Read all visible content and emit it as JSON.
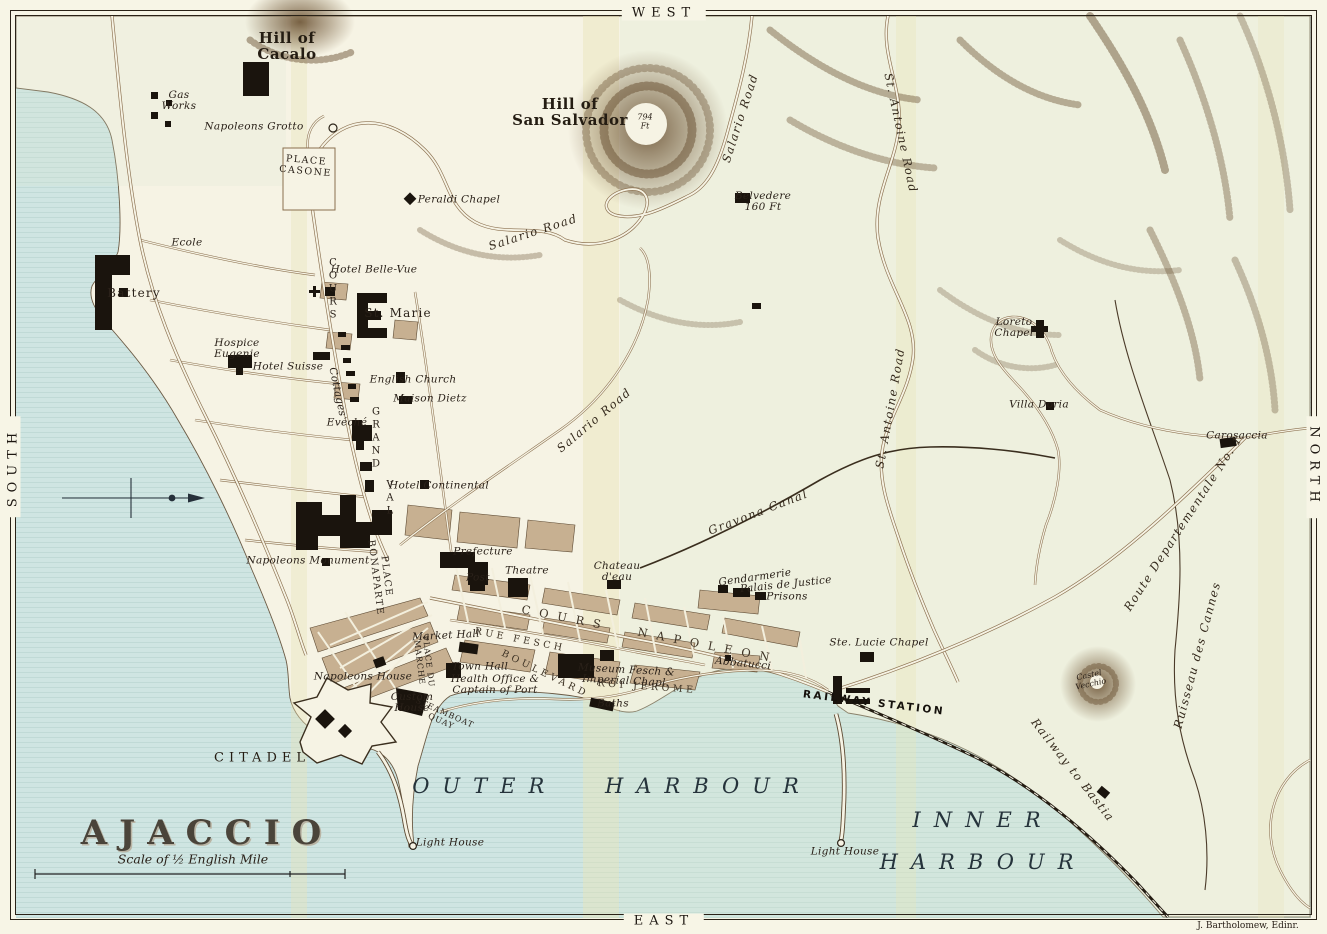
{
  "map": {
    "title": "AJACCIO",
    "scale_label": "Scale of ½ English Mile",
    "attribution": "J. Bartholomew, Edinr.",
    "compass": {
      "top": "WEST",
      "bottom": "EAST",
      "left": "SOUTH",
      "right": "NORTH"
    },
    "colors": {
      "sea": "#cfe5e2",
      "land": "#f6f3e4",
      "buildings": "#1a140d",
      "blocks": "#c7b091",
      "hills": "#6e5638",
      "fold_band": "#e8e4b8"
    }
  },
  "labels": [
    {
      "name": "hill-of-cacalo",
      "text": "Hill of\nCacalo",
      "x": 287,
      "y": 46,
      "rot": 0,
      "cls": "hill"
    },
    {
      "name": "gas-works",
      "text": "Gas\nWorks",
      "x": 179,
      "y": 101,
      "rot": 0,
      "cls": "place"
    },
    {
      "name": "napoleons-grotto",
      "text": "Napoleons Grotto",
      "x": 254,
      "y": 127,
      "rot": 0,
      "cls": "place"
    },
    {
      "name": "place-casone",
      "text": "PLACE\nCASONE",
      "x": 306,
      "y": 166,
      "rot": 5,
      "cls": "district"
    },
    {
      "name": "peraldi-chapel",
      "text": "Peraldi Chapel",
      "x": 459,
      "y": 200,
      "rot": 0,
      "cls": "place"
    },
    {
      "name": "hill-of-san-salvador",
      "text": "Hill of\nSan Salvador",
      "x": 570,
      "y": 112,
      "rot": 0,
      "cls": "hill"
    },
    {
      "name": "summit-height",
      "text": "794\nFt",
      "x": 645,
      "y": 122,
      "rot": 0,
      "cls": "tiny"
    },
    {
      "name": "belvedere",
      "text": "Belvedere\n160 Ft",
      "x": 763,
      "y": 202,
      "rot": 0,
      "cls": "place"
    },
    {
      "name": "salario-road-north",
      "text": "Salario Road",
      "x": 740,
      "y": 118,
      "rot": -72,
      "cls": "road"
    },
    {
      "name": "salario-road-mid",
      "text": "Salario Road",
      "x": 533,
      "y": 232,
      "rot": -18,
      "cls": "road"
    },
    {
      "name": "salario-road-south",
      "text": "Salario Road",
      "x": 594,
      "y": 420,
      "rot": -40,
      "cls": "road"
    },
    {
      "name": "ecole",
      "text": "Ecole",
      "x": 187,
      "y": 243,
      "rot": 0,
      "cls": "place"
    },
    {
      "name": "battery",
      "text": "Battery",
      "x": 134,
      "y": 293,
      "rot": 0,
      "cls": "town"
    },
    {
      "name": "hospice-eugenie",
      "text": "Hospice\nEugenie",
      "x": 237,
      "y": 349,
      "rot": 0,
      "cls": "place"
    },
    {
      "name": "hotel-suisse",
      "text": "Hotel Suisse",
      "x": 288,
      "y": 367,
      "rot": 0,
      "cls": "place"
    },
    {
      "name": "cottages",
      "text": "Cottages",
      "x": 337,
      "y": 392,
      "rot": 78,
      "cls": "place"
    },
    {
      "name": "hotel-belle-vue",
      "text": "Hotel Belle-Vue",
      "x": 374,
      "y": 270,
      "rot": 0,
      "cls": "place"
    },
    {
      "name": "st-marie",
      "text": "St. Marie",
      "x": 398,
      "y": 313,
      "rot": 0,
      "cls": "town"
    },
    {
      "name": "english-church",
      "text": "English Church",
      "x": 413,
      "y": 380,
      "rot": 0,
      "cls": "place"
    },
    {
      "name": "maison-dietz",
      "text": "Maison Dietz",
      "x": 430,
      "y": 399,
      "rot": 0,
      "cls": "place"
    },
    {
      "name": "eveche",
      "text": "Evéché",
      "x": 347,
      "y": 423,
      "rot": 0,
      "cls": "place"
    },
    {
      "name": "cours-grandval-c",
      "text": "C\nO\nU\nR\nS",
      "x": 333,
      "y": 289,
      "rot": 0,
      "cls": "stack"
    },
    {
      "name": "cours-grandval-g",
      "text": "G\nR\nA\nN\nD",
      "x": 376,
      "y": 438,
      "rot": 0,
      "cls": "stack"
    },
    {
      "name": "cours-grandval-v",
      "text": "V\nA\nL",
      "x": 390,
      "y": 498,
      "rot": 0,
      "cls": "stack"
    },
    {
      "name": "hotel-continental",
      "text": "Hotel Continental",
      "x": 439,
      "y": 486,
      "rot": 0,
      "cls": "place"
    },
    {
      "name": "napoleons-monument",
      "text": "Napoleons Monument",
      "x": 308,
      "y": 561,
      "rot": 0,
      "cls": "place"
    },
    {
      "name": "place-bonaparte",
      "text": "PLACE\nBONAPARTE",
      "x": 381,
      "y": 577,
      "rot": 83,
      "cls": "district"
    },
    {
      "name": "prefecture",
      "text": "Prefecture",
      "x": 483,
      "y": 552,
      "rot": 0,
      "cls": "place"
    },
    {
      "name": "post",
      "text": "Post",
      "x": 478,
      "y": 578,
      "rot": 0,
      "cls": "place"
    },
    {
      "name": "theatre",
      "text": "Theatre",
      "x": 527,
      "y": 571,
      "rot": 0,
      "cls": "place"
    },
    {
      "name": "chateau-deau",
      "text": "Chateau\nd'eau",
      "x": 617,
      "y": 572,
      "rot": 0,
      "cls": "place"
    },
    {
      "name": "cours-napoleon",
      "text": "COURS NAPOLEON",
      "x": 650,
      "y": 634,
      "rot": 11,
      "cls": "avenue"
    },
    {
      "name": "rue-fesch",
      "text": "RUE FESCH",
      "x": 520,
      "y": 640,
      "rot": 11,
      "cls": "street"
    },
    {
      "name": "boulevard-roi-jerome-1",
      "text": "BOULEVARD",
      "x": 545,
      "y": 674,
      "rot": 26,
      "cls": "street"
    },
    {
      "name": "boulevard-roi-jerome-2",
      "text": "ROI JEROME",
      "x": 647,
      "y": 687,
      "rot": 4,
      "cls": "street"
    },
    {
      "name": "market-hall",
      "text": "Market Hall",
      "x": 446,
      "y": 636,
      "rot": -3,
      "cls": "place"
    },
    {
      "name": "town-hall",
      "text": "Town Hall",
      "x": 480,
      "y": 667,
      "rot": 0,
      "cls": "place"
    },
    {
      "name": "health-office",
      "text": "Health Office &\nCaptain of Port",
      "x": 495,
      "y": 685,
      "rot": 0,
      "cls": "place"
    },
    {
      "name": "napoleons-house",
      "text": "Napoleons House",
      "x": 363,
      "y": 677,
      "rot": 0,
      "cls": "place"
    },
    {
      "name": "place-du-marche",
      "text": "PLACE DU\nMARCHE",
      "x": 424,
      "y": 662,
      "rot": 83,
      "cls": "districtsm"
    },
    {
      "name": "custom-house",
      "text": "Custom\nHouse",
      "x": 412,
      "y": 703,
      "rot": 0,
      "cls": "place"
    },
    {
      "name": "steamboat-quay",
      "text": "STEAMBOAT\nQUAY",
      "x": 443,
      "y": 717,
      "rot": 24,
      "cls": "districtsm"
    },
    {
      "name": "museum-fesch",
      "text": "Museum Fesch &\nImperial Chapl.",
      "x": 626,
      "y": 676,
      "rot": 3,
      "cls": "place"
    },
    {
      "name": "baths",
      "text": "Baths",
      "x": 613,
      "y": 704,
      "rot": 0,
      "cls": "place"
    },
    {
      "name": "abbatucci",
      "text": "Abbatucci",
      "x": 743,
      "y": 664,
      "rot": 6,
      "cls": "place"
    },
    {
      "name": "gendarmerie",
      "text": "Gendarmerie",
      "x": 755,
      "y": 578,
      "rot": -8,
      "cls": "place"
    },
    {
      "name": "palais-de-justice",
      "text": "Palais de Justice",
      "x": 786,
      "y": 585,
      "rot": -6,
      "cls": "place"
    },
    {
      "name": "prisons",
      "text": "Prisons",
      "x": 787,
      "y": 597,
      "rot": 0,
      "cls": "place"
    },
    {
      "name": "ste-lucie-chapel",
      "text": "Ste. Lucie Chapel",
      "x": 879,
      "y": 643,
      "rot": 0,
      "cls": "place"
    },
    {
      "name": "railway-station",
      "text": "RAILWAY STATION",
      "x": 874,
      "y": 703,
      "rot": 7,
      "cls": "station"
    },
    {
      "name": "gravona-canal",
      "text": "Gravona Canal",
      "x": 758,
      "y": 512,
      "rot": -21,
      "cls": "road"
    },
    {
      "name": "st-antoine-road-north",
      "text": "St. Antoine Road",
      "x": 901,
      "y": 133,
      "rot": 78,
      "cls": "road"
    },
    {
      "name": "st-antoine-road-south",
      "text": "St. Antoine Road",
      "x": 890,
      "y": 408,
      "rot": -80,
      "cls": "road"
    },
    {
      "name": "loreto-chapel",
      "text": "Loreto\nChapel",
      "x": 1014,
      "y": 328,
      "rot": 0,
      "cls": "place"
    },
    {
      "name": "villa-doria",
      "text": "Villa Doria",
      "x": 1039,
      "y": 405,
      "rot": 0,
      "cls": "place"
    },
    {
      "name": "carosaccia",
      "text": "Carosaccia",
      "x": 1237,
      "y": 436,
      "rot": 0,
      "cls": "place"
    },
    {
      "name": "route-departementale",
      "text": "Route Departementale No. 1",
      "x": 1183,
      "y": 523,
      "rot": -57,
      "cls": "road"
    },
    {
      "name": "ruisseau-des-cannes",
      "text": "Ruisseau des Cannes",
      "x": 1197,
      "y": 655,
      "rot": -75,
      "cls": "road"
    },
    {
      "name": "castel-vecchio",
      "text": "Castel\nVecchio",
      "x": 1090,
      "y": 680,
      "rot": -12,
      "cls": "tiny"
    },
    {
      "name": "railway-to-bastia",
      "text": "Railway to Bastia",
      "x": 1073,
      "y": 770,
      "rot": 52,
      "cls": "road"
    },
    {
      "name": "citadel",
      "text": "CITADEL",
      "x": 262,
      "y": 758,
      "rot": 0,
      "cls": "districtlg"
    },
    {
      "name": "outer-harbour",
      "text": "OUTER HARBOUR",
      "x": 612,
      "y": 786,
      "rot": 0,
      "cls": "water"
    },
    {
      "name": "inner-harbour",
      "text": "INNER\nHARBOUR",
      "x": 983,
      "y": 841,
      "rot": 0,
      "cls": "water"
    },
    {
      "name": "light-house-west",
      "text": "Light House",
      "x": 450,
      "y": 843,
      "rot": 0,
      "cls": "place"
    },
    {
      "name": "light-house-east",
      "text": "Light House",
      "x": 845,
      "y": 852,
      "rot": 0,
      "cls": "place"
    }
  ]
}
